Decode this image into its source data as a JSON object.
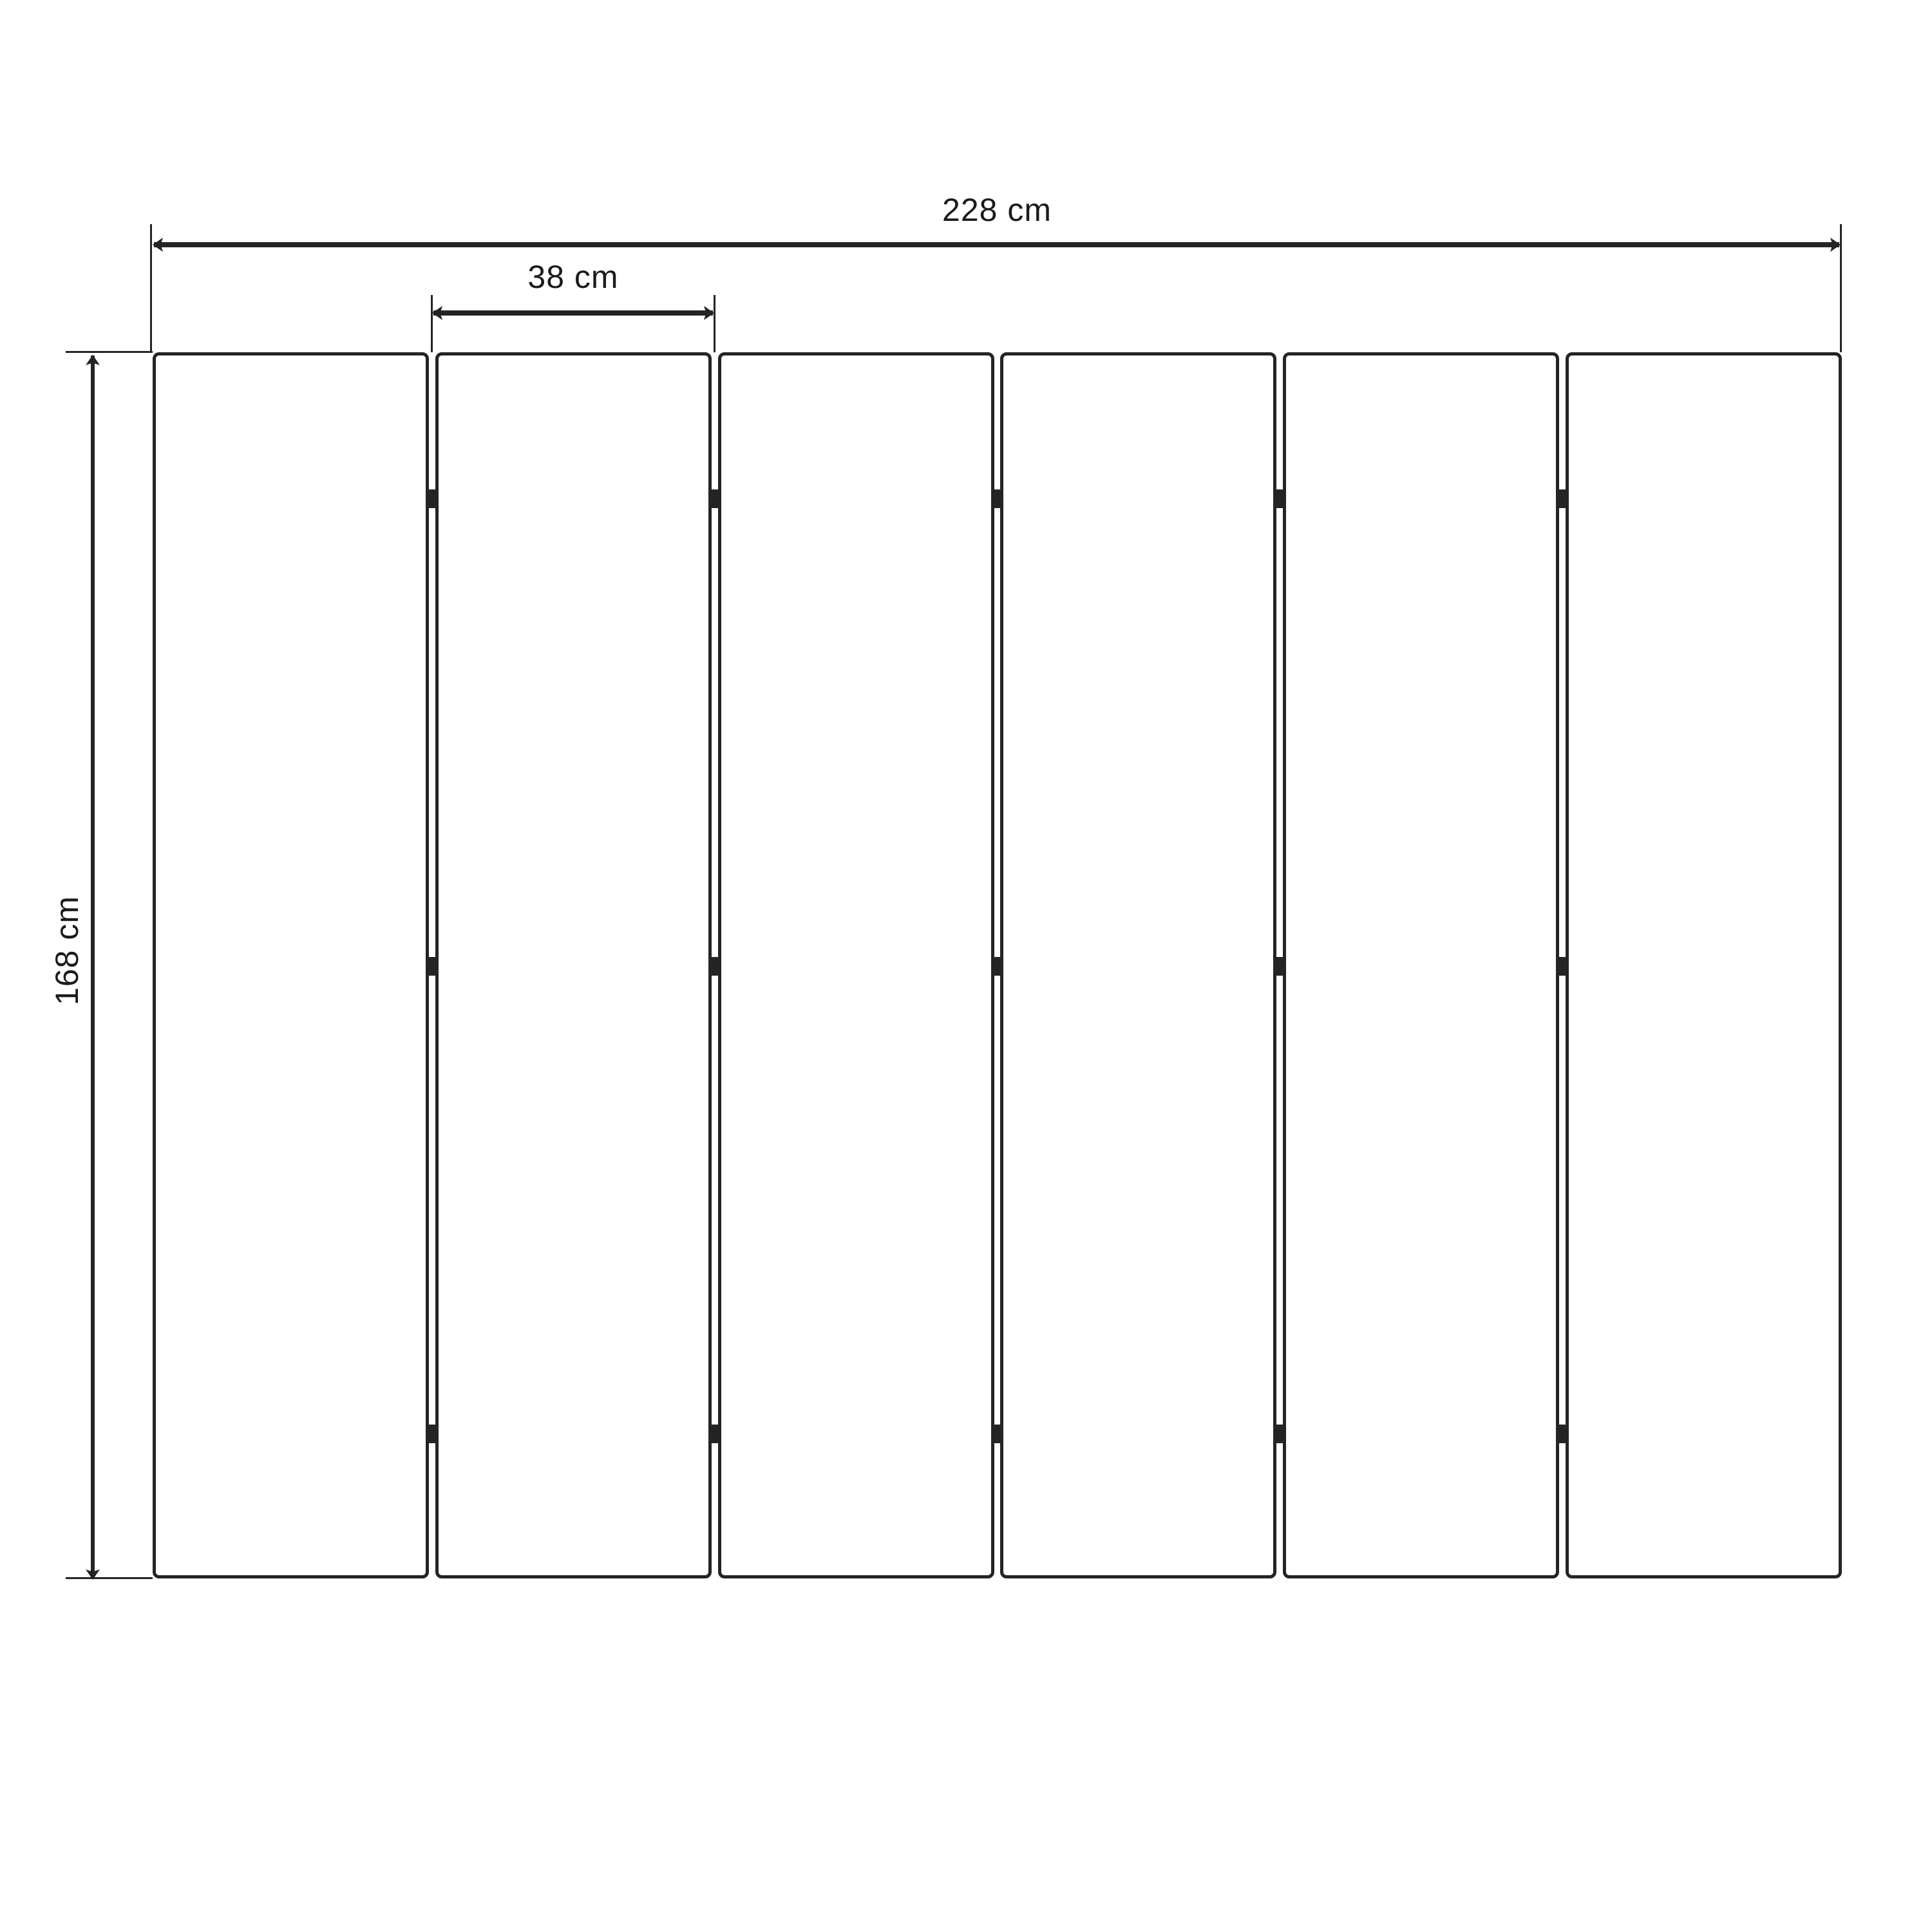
{
  "diagram": {
    "type": "panel-screen-dimension-drawing",
    "panels": {
      "count": 6,
      "hinges_per_gap": 3
    },
    "dimensions": {
      "total_width": {
        "label": "228 cm",
        "value": 228,
        "unit": "cm"
      },
      "panel_width": {
        "label": "38 cm",
        "value": 38,
        "unit": "cm"
      },
      "height": {
        "label": "168 cm",
        "value": 168,
        "unit": "cm"
      }
    },
    "colors": {
      "ink": "#242424",
      "background": "#ffffff"
    }
  }
}
